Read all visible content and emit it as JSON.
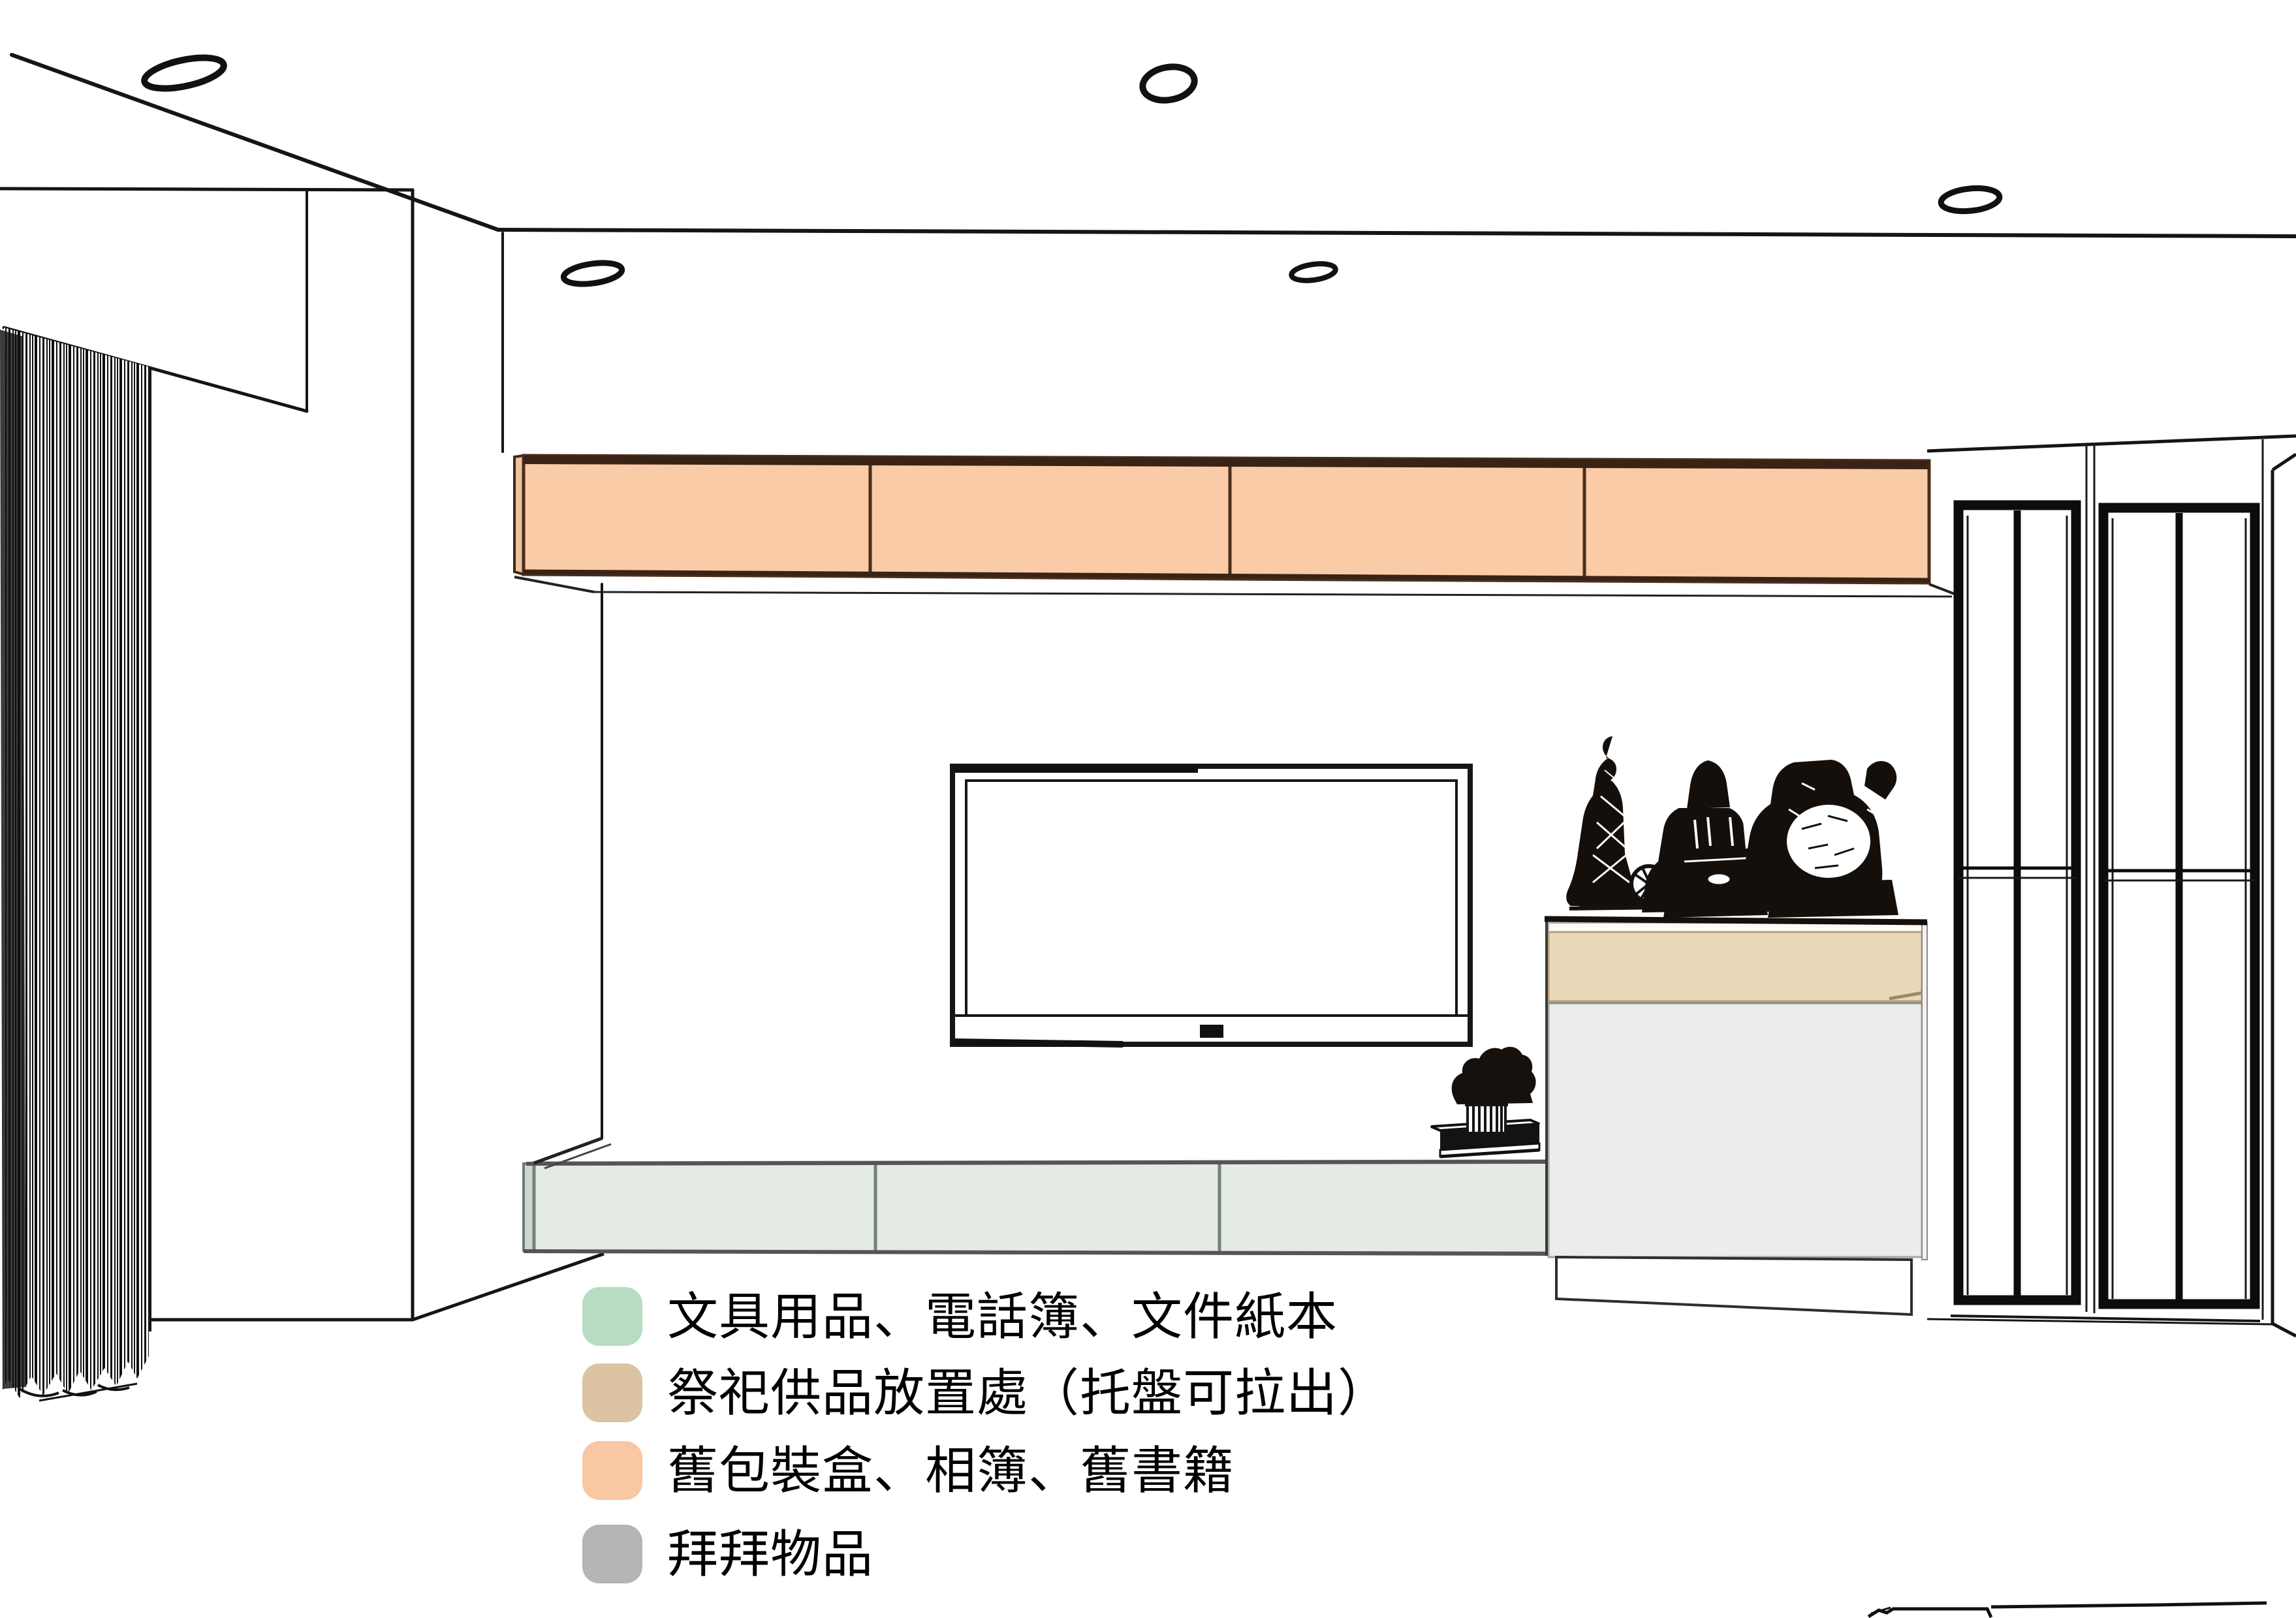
{
  "document": {
    "kind": "interior elevation drawing",
    "subject": "living room TV wall storage plan"
  },
  "legend": {
    "items": [
      {
        "id": "green",
        "color": "#b8dcc1",
        "label": "文具用品、電話簿、文件紙本"
      },
      {
        "id": "tan",
        "color": "#dcc3a1",
        "label": "祭祀供品放置處（托盤可拉出）"
      },
      {
        "id": "peach",
        "color": "#f9c7a3",
        "label": "舊包裝盒、相簿、舊書籍"
      },
      {
        "id": "gray",
        "color": "#b5b5b4",
        "label": "拜拜物品"
      }
    ]
  },
  "zones": {
    "upper_cabinet": {
      "color": "#f9cba7",
      "doors": 4,
      "purpose": "舊包裝盒、相簿、舊書籍"
    },
    "tv_cabinet": {
      "color": "#e3ebe2",
      "doors": 3,
      "purpose": "文具用品、電話簿、文件紙本"
    },
    "offering_tray": {
      "color": "#ead8ba",
      "purpose": "祭祀供品放置處（托盤可拉出）"
    },
    "worship_cabinet": {
      "color": "#eaedea",
      "purpose": "拜拜物品"
    }
  },
  "scene": {
    "downlights": 5,
    "statues": 3,
    "display_cabinets": 2,
    "tv": 1,
    "curtain_side": "left"
  }
}
